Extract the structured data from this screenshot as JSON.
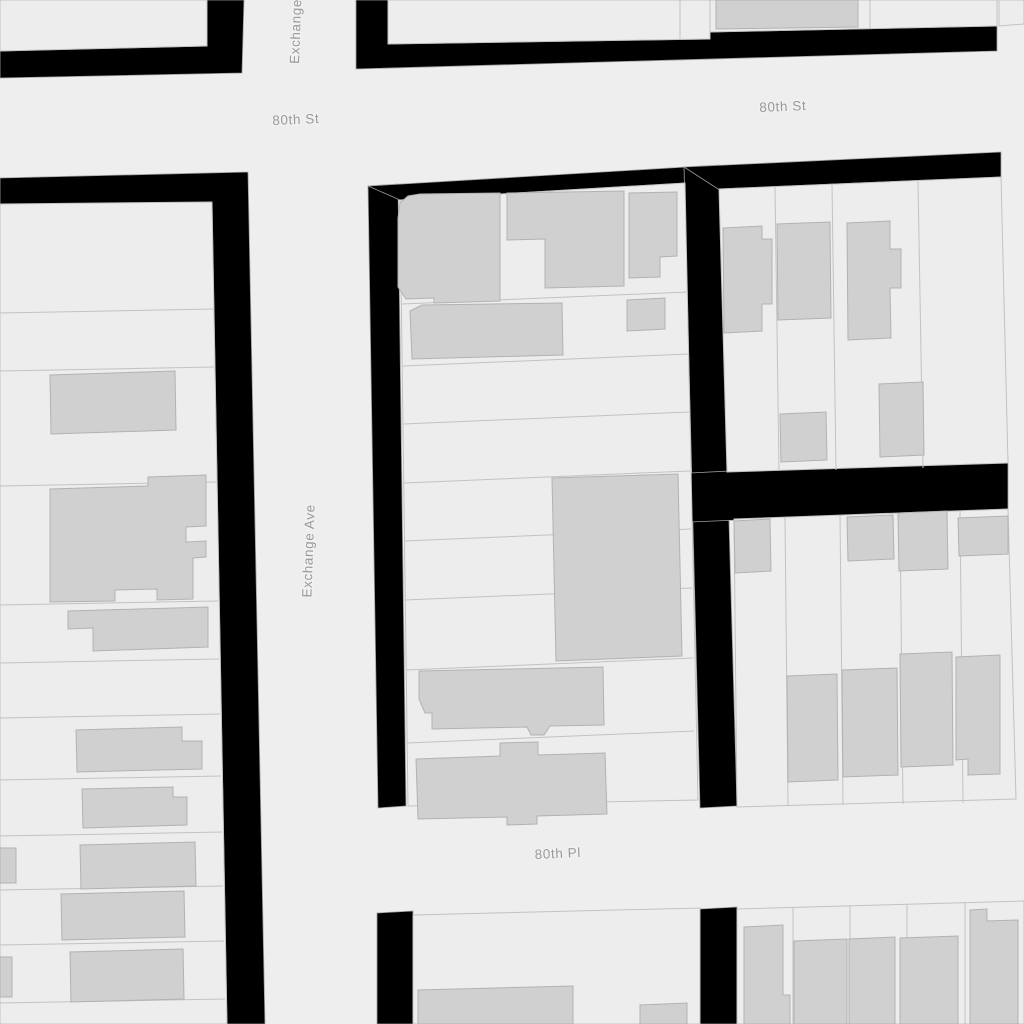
{
  "map": {
    "canvas": {
      "width": 1024,
      "height": 1024
    },
    "colors": {
      "street_fill": "#eeeeee",
      "parcel_fill": "#ededed",
      "parcel_stroke": "#c2c2c2",
      "building_fill": "#d0d0d0",
      "building_stroke": "#b2b2b2",
      "block_fill": "#000000",
      "block_stroke": "#a0a0a0",
      "label_color": "#9a9a9a",
      "label_halo": "#f1f1f1"
    },
    "street_labels": [
      {
        "name": "street-label-80th-st-west",
        "text": "80th St",
        "x": 296,
        "y": 124,
        "rotate": -2.5,
        "anchor": "middle"
      },
      {
        "name": "street-label-80th-st-east",
        "text": "80th St",
        "x": 783,
        "y": 111,
        "rotate": -2.5,
        "anchor": "middle"
      },
      {
        "name": "street-label-80th-pl",
        "text": "80th Pl",
        "x": 558,
        "y": 858,
        "rotate": -2.5,
        "anchor": "middle"
      },
      {
        "name": "street-label-exchange-ave",
        "text": "Exchange Ave",
        "x": 313,
        "y": 551,
        "rotate": -88,
        "anchor": "middle"
      },
      {
        "name": "street-label-exchange-ave-top",
        "text": "Exchange Ave",
        "x": 299,
        "y": 64,
        "rotate": -88,
        "anchor": "start"
      }
    ],
    "blocks": [
      {
        "name": "block-border-topleft",
        "points": "0,51 207,46 207,0 244,0 242,73 0,78"
      },
      {
        "name": "block-border-topright",
        "points": "356,0 388,0 388,44 710,39 710,32 997,26 997,51 356,69"
      },
      {
        "name": "block-border-west",
        "points": "0,178 248,172 265,1024 227,1024 212,204 0,205"
      },
      {
        "name": "block-border-mid-left",
        "points": "368,186 398,184 406,806 378,808"
      },
      {
        "name": "block-border-mid-top",
        "points": "368,186 686,167 685,183 400,200"
      },
      {
        "name": "alley-north-south",
        "points": "684,167 719,165 737,806 700,808"
      },
      {
        "name": "alley-east-west",
        "points": "690,473 1008,457 1008,509 690,522"
      },
      {
        "name": "block-border-east-top",
        "points": "684,167 1001,152 1001,177 718,189"
      },
      {
        "name": "block-border-bottom-left",
        "points": "377,913 413,911 413,1024 377,1024"
      },
      {
        "name": "block-border-bottom-right",
        "points": "700,909 737,907 737,1024 700,1024"
      }
    ],
    "parcels": [
      {
        "name": "parcel-block-topleft",
        "points": "0,0 207,0 207,46 0,51"
      },
      {
        "name": "parcel-block-top-1",
        "points": "388,0 710,0 710,39 388,44"
      },
      {
        "name": "parcel-block-top-2",
        "points": "710,0 997,0 997,26 710,32"
      },
      {
        "name": "parcel-block-top-3",
        "points": "999,0 1024,0 1024,24 999,26"
      },
      {
        "name": "parcel-block-west",
        "points": "0,204 212,202 227,1024 0,1024"
      },
      {
        "name": "parcel-block-middle",
        "points": "400,200 685,183 698,800 408,806"
      },
      {
        "name": "parcel-block-east-top",
        "points": "719,189 1001,177 1008,463 727,472"
      },
      {
        "name": "parcel-block-east-bot",
        "points": "734,519 1008,509 1016,799 737,807"
      },
      {
        "name": "parcel-block-south-east",
        "points": "737,909 1024,901 1024,1024 737,1024"
      },
      {
        "name": "parcel-block-south-mid",
        "points": "413,915 700,908 700,1024 413,1024"
      }
    ],
    "parcel_lines": [
      {
        "name": "lot-line",
        "points": "680,0 680,40"
      },
      {
        "name": "lot-line",
        "points": "870,0 870,29"
      },
      {
        "name": "lot-line",
        "points": "0,313 214,309"
      },
      {
        "name": "lot-line",
        "points": "0,371 214,367"
      },
      {
        "name": "lot-line",
        "points": "0,486 216,482"
      },
      {
        "name": "lot-line",
        "points": "0,605 218,601"
      },
      {
        "name": "lot-line",
        "points": "0,663 219,659"
      },
      {
        "name": "lot-line",
        "points": "0,718 220,714"
      },
      {
        "name": "lot-line",
        "points": "0,780 221,776"
      },
      {
        "name": "lot-line",
        "points": "0,836 222,832"
      },
      {
        "name": "lot-line",
        "points": "0,890 223,886"
      },
      {
        "name": "lot-line",
        "points": "0,945 224,941"
      },
      {
        "name": "lot-line",
        "points": "0,1003 225,999"
      },
      {
        "name": "lot-line",
        "points": "402,304 688,292"
      },
      {
        "name": "lot-line",
        "points": "403,366 689,354"
      },
      {
        "name": "lot-line",
        "points": "403,424 689,412"
      },
      {
        "name": "lot-line",
        "points": "404,483 690,471"
      },
      {
        "name": "lot-line",
        "points": "404,541 691,529"
      },
      {
        "name": "lot-line",
        "points": "405,600 692,588"
      },
      {
        "name": "lot-line",
        "points": "406,670 693,658"
      },
      {
        "name": "lot-line",
        "points": "407,743 694,731"
      },
      {
        "name": "lot-line",
        "points": "775,187 779,471"
      },
      {
        "name": "lot-line",
        "points": "832,185 836,470"
      },
      {
        "name": "lot-line",
        "points": "918,181 923,468"
      },
      {
        "name": "lot-line",
        "points": "785,517 788,806"
      },
      {
        "name": "lot-line",
        "points": "840,515 843,805"
      },
      {
        "name": "lot-line",
        "points": "900,513 903,804"
      },
      {
        "name": "lot-line",
        "points": "960,511 963,803"
      },
      {
        "name": "lot-line",
        "points": "793,907 793,1024"
      },
      {
        "name": "lot-line",
        "points": "850,906 850,1024"
      },
      {
        "name": "lot-line",
        "points": "907,904 907,1024"
      },
      {
        "name": "lot-line",
        "points": "965,903 965,1024"
      }
    ],
    "buildings": [
      {
        "name": "building",
        "points": "716,0 858,0 858,27 716,29"
      },
      {
        "name": "building",
        "points": "50,375 175,371 176,430 51,434"
      },
      {
        "name": "building",
        "points": "50,489 148,486 148,477 206,475 206,526 186,527 186,542 206,541 206,557 193,558 193,599 157,600 157,589 115,590 115,601 50,602"
      },
      {
        "name": "building",
        "points": "68,611 208,607 208,647 93,651 93,628 68,629"
      },
      {
        "name": "building",
        "points": "76,730 182,727 182,741 202,741 202,769 77,772"
      },
      {
        "name": "building",
        "points": "82,789 173,787 173,797 187,797 187,825 83,828"
      },
      {
        "name": "building",
        "points": "80,845 195,842 196,886 81,889"
      },
      {
        "name": "building",
        "points": "0,848 16,848 16,883 0,883"
      },
      {
        "name": "building",
        "points": "61,894 184,891 185,937 62,940"
      },
      {
        "name": "building",
        "points": "70,952 183,949 184,999 71,1002"
      },
      {
        "name": "building",
        "points": "0,957 12,957 12,997 0,997"
      },
      {
        "name": "building",
        "points": "398,218 400,203 408,196 420,194 500,193 500,301 434,303 434,298 406,299 398,287"
      },
      {
        "name": "building",
        "points": "507,193 624,191 624,286 545,288 545,239 507,240"
      },
      {
        "name": "building",
        "points": "629,193 677,192 677,256 660,257 660,277 629,278"
      },
      {
        "name": "building",
        "points": "410,311 422,305 562,303 563,355 412,359"
      },
      {
        "name": "building",
        "points": "627,300 665,298 665,329 627,331"
      },
      {
        "name": "building",
        "points": "552,478 678,474 682,656 556,661"
      },
      {
        "name": "building",
        "points": "419,671 603,667 604,725 550,726 544,735 531,735 527,727 432,729 432,713 425,713 419,699"
      },
      {
        "name": "building",
        "points": "416,759 500,756 500,743 538,742 538,755 605,753 607,814 537,816 537,824 507,825 507,817 418,819"
      },
      {
        "name": "building",
        "points": "723,228 762,226 762,239 772,239 772,304 762,304 762,331 724,333"
      },
      {
        "name": "building",
        "points": "777,224 830,222 831,318 778,320"
      },
      {
        "name": "building",
        "points": "847,223 890,221 890,249 901,249 901,288 890,288 891,338 848,340"
      },
      {
        "name": "building",
        "points": "780,414 826,412 827,460 781,462"
      },
      {
        "name": "building",
        "points": "879,384 923,382 924,455 880,457"
      },
      {
        "name": "building",
        "points": "734,521 770,519 771,571 735,573"
      },
      {
        "name": "building",
        "points": "847,517 893,515 894,559 848,561"
      },
      {
        "name": "building",
        "points": "898,513 947,511 948,569 899,571"
      },
      {
        "name": "building",
        "points": "958,518 1008,516 1008,554 959,556"
      },
      {
        "name": "building",
        "points": "787,676 837,674 838,780 788,782"
      },
      {
        "name": "building",
        "points": "842,670 897,668 898,775 843,777"
      },
      {
        "name": "building",
        "points": "900,654 952,652 953,765 901,767"
      },
      {
        "name": "building",
        "points": "956,657 1000,655 1000,774 968,775 968,759 956,760"
      },
      {
        "name": "building",
        "points": "744,927 783,925 783,995 790,995 790,1024 744,1024"
      },
      {
        "name": "building",
        "points": "794,941 847,939 847,1024 794,1024"
      },
      {
        "name": "building",
        "points": "849,939 895,937 895,1024 849,1024"
      },
      {
        "name": "building",
        "points": "900,938 958,936 958,1024 900,1024"
      },
      {
        "name": "building",
        "points": "970,910 987,909 987,921 1018,920 1018,1024 970,1024"
      },
      {
        "name": "building",
        "points": "418,990 573,986 573,1024 418,1024"
      },
      {
        "name": "building",
        "points": "640,1005 687,1003 687,1024 640,1024"
      }
    ]
  }
}
